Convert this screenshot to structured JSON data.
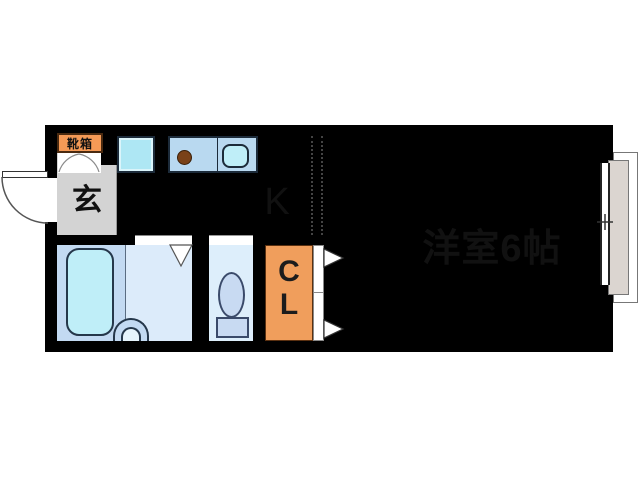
{
  "plan": {
    "type": "apartment-floor-plan",
    "labels": {
      "shoe_box": "靴箱",
      "entrance": "玄",
      "kitchen": "K",
      "closet_letter_1": "C",
      "closet_letter_2": "L",
      "main_room": "洋室6帖"
    },
    "fixtures": [
      "entrance-door",
      "shoe-cabinet-doors",
      "washing-machine-space",
      "gas-stove-burner",
      "kitchen-sink",
      "bathtub",
      "wash-basin",
      "bathroom-folding-door",
      "toilet",
      "closet-folding-doors",
      "sliding-window",
      "balcony"
    ],
    "colors": {
      "wall": "#000000",
      "floor": "#f3d2b4",
      "entrance_floor": "#d3d3d3",
      "bath_platform": "#c3daf2",
      "bath_floor": "#dcebfa",
      "toilet_floor": "#ddeefb",
      "water_fixture": "#bfeef8",
      "kitchen_counter": "#b9d9f0",
      "toilet_fixture": "#c8daf2",
      "closet_orange": "#f09e5c",
      "shoebox_orange": "#f59a56",
      "burner_brown": "#7a4218",
      "balcony_gray": "#dbd5d0"
    }
  }
}
